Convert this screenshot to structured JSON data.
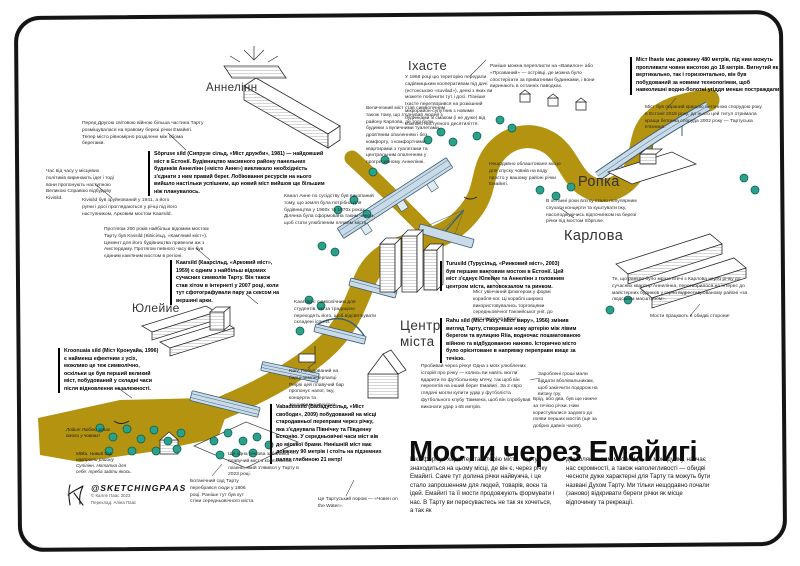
{
  "poster": {
    "title": "Мости через Емайигі",
    "intro_col1": "Ріка формує характер та історію міста. Тарту знаходиться на цьому місці, де він є, через річку Емайигі. Саме тут долина річки найвужча, і це стало запрошенням для людей, товарів, воєн та ідей. Емайигі та її мости продовжують формувати і нас. В Тарту ви пересуваєтесь не так як хочеться, а так як",
    "intro_col2": "дозволяють вам мости. Це, на мою думку, навчає нас скромності, а також наполегливості — обидві чесноти дуже характерні для Тарту та можуть бути названі Духом Тарту. Ми тільки нещодавно почали (заново) відкривати береги річки як місце відпочинку та рекреації."
  },
  "districts": {
    "annelinn": "Аннелінн",
    "ihaste": "Іхасте",
    "ropka": "Ропка",
    "karlova": "Карлова",
    "ulejoe": "Юлейие",
    "centre": "Центр міста"
  },
  "notes": {
    "prewar": "Перед Другою світовою війною більша частина Тарту розміщувалася на правому березі річки Емайигі. Тепер місто рівномірно розділене між обома берегами.",
    "politicians": "Час від часу у місцевих політиків виринають ідеї і тоді вони пропонують наступною Великою Справою відбудову Kivisild.",
    "kivisild_ruins": "Kivisild був зруйнований у 1941, а його руїни і досі проглядаються у річці під його наступником, Арковим мостом Kaarsild.",
    "kivisild_history": "Протягом 200 років найбільш відомим мостом Тарту був Kivisild (Ківісільд, «Кам'яний міст»). Цемент для його будівництва привезли аж з Амстердаму. Протягом певного часу він був єдиним кам'яним мостом в регіоні.",
    "sopruse": "Sõpruse sild (Сипрузе сільд, «Міст дружби», 1981) — найдовший міст в Естонії. Будівництво масивного району панельних будинків Аннелінн («місто Анне») викликало необхідність з'єднати з ним правий берег. Лобіювання ресурсів на нього вийшло настільки успішним, що новий міст вийшов ще більшим ніж планувалось.",
    "kaarsild": "Kaarsild (Каарсільд, «Арковий міст», 1959) є одним з найбільш відомих сучасних символів Тарту. Він також став хітом в інтернеті у 2007 році, коли тут сфотографували пару за сексом на вершині арки.",
    "kaarsild_students": "Kaarsild є символічним для студентів, які за традицією переходять його, щоб відсвяткувати складені іспити.",
    "kroonuaia": "Kroonuaia sild (Міст Кронуайа, 1996) є найменш ефектним з усіх, можливо це теж символічно, оскільки це був перший великий міст, побудований у складні часи після відновлення незалежності.",
    "naiv": "Naiv. Побудований на барці-землечерпалці Peipsi цей плавучий бар пропонує напої, їжу, концерти та танцювальні вечірки.",
    "vabadussild": "Vabadussild (Вабадуссільд, «Міст свободи», 2009) побудований на місці стародавньої переправи через річку, яка з'єднувала Північну та Південну Естонію. У середньовічні часи міст вів до міської брами. Нинішній міст має довжину 90 метрів і стоїть на підземних палях глибиною 21 метр!",
    "football": "Пробивай через річку! Одна з моїх улюблених історій про річку — колись ви навіть могли вдарити по футбольному м'ячу, так щоб він перелетів на інший берег Емайигі. За 2 євро глядачі могли купити удар у футболіста футбольного клубу Таммека, щоб він спробував виконати удар з 65 метрів.",
    "money": "Зароблені гроші мали віддати вболівальникам, щоб закінчити подорож на виїзну гру.",
    "ford": "Брід, або два, був ще нижче за течією річки. Ним користувалися задовго до появи перших мостів (ще за добрих давніх часів!).",
    "rahusild": "Rahu sild (Міст Раху, «Міст миру», 1956) змінив вигляд Тарту, створивши нову артерію між лівим берегом та вулицею Riia, водночас пошматованою війною та відбудованою наново. Історично місто було орієнтоване в напрямку переправи вище за течією.",
    "turusild": "Turusild (Турусільд, «Ринковий міст», 2003) був першим вантовим мостом в Естонії. Цей міст з'єднує Юлейие та Аннелінн з головним центром міста, автовокзалом та ринком.",
    "kogge": "Міст увінчаний флюгером у формі корабля-ког. Ці кораблі широко використовувались торговцями середньовічної Ганзейської унії, до якої належав і Тарту.",
    "ihaste_bridge": "Міст Ihaste має довжину 480 метрів, під ним можуть пропливати човни висотою до 18 метрів. Вигнутий як вертикально, так і горизонтально, він був побудований за новими технологіями, щоб навколишні водно-болотні угіддя менше постраждали.",
    "concrete_award": "Міст був обраний кращою бетонною спорудою року в Естонії 2015 року, до нього цей титул отримала краща бетонна споруда 2002 року — Тартуська в'язниця.",
    "ihaste_area": "У 1968 році цю територію передали садівницьким кооперативам під дачі (естонською «suvilad»), деякі з яких ви можете побачити тут і досі. Пізніше Іхасте перетворився на розкішний мікрорайон-супутник з новими будинками зі смаком (і не дуже) від кожного наступного десятиліття.",
    "babylon": "Раніше можна переплисти на «Вавилон» або «Прозваний» — острівці, де можна було спостерігати за приватними будинками, і вони виринають в останніх паводках.",
    "karlova_link": "Величезний міст став символічним також тому, що з'єднував людей з району Карлова, де тоді були будинки з вуличними туалетами, дров'яним опаленням і без комфорту, з комфортними квартирами з туалетами та центральним опаленням у прогресивному Аннелінні.",
    "anne_canal": "Канал Анне по сусідству був викопаний тому, що земля була потрібна для будівництва у 1960х та 1970х роках. Ділянка була сформована таким чином, щоб стати улюбленим пляжем міста.",
    "boat_launch": "Нещодавно облаштоване місце для спуску човнів на воду просто у вашому районі річки Емайигі.",
    "concerts": "В останні роки влітку стало популярним слухати концерти та куштувати їжу, насолоджуючись відпочинком на березі річки під мостом Sõpruse.",
    "karlova_change": "Те, що раніше було мрією втечі з Карлова через річку до сучасних квартир Аннелінна, перетворилося на інтерес до майстерних будинків у гарно відреставрованому районі «за людським масштабом».",
    "both_ways": "Мости працюють в обидві сторони!",
    "lodja": "Лодья! Люблю запах смоли у човнах!",
    "moku": "Möku. Новий бар навпроти району Супілінн. Нотатка для себе: треба зайти якось.",
    "botanical": "Ботанічний сад Тарту перебрався сюди у 1806 році. Раніше тут був кут стіни середньовічного міста.",
    "sauna": "Ще одна річкова забаганка — плавучий міст з комплексом лазень, який з'явився у Тарту в 2023 році.",
    "ferry": "Це Тартуський пором — «Човен on the Water»."
  },
  "signature": {
    "handle": "@SKETCHINGPAAS",
    "copyright": "© Калле Паас 2023",
    "translation": "Переклад: Аліна Паас"
  },
  "colors": {
    "river": "#b3930f",
    "tree": "#2aa18b",
    "treeDark": "#0d5a4b",
    "bridge": "#c9dbe8",
    "bridgeStroke": "#3c5f77",
    "frame": "#151515",
    "ink": "#222222"
  }
}
